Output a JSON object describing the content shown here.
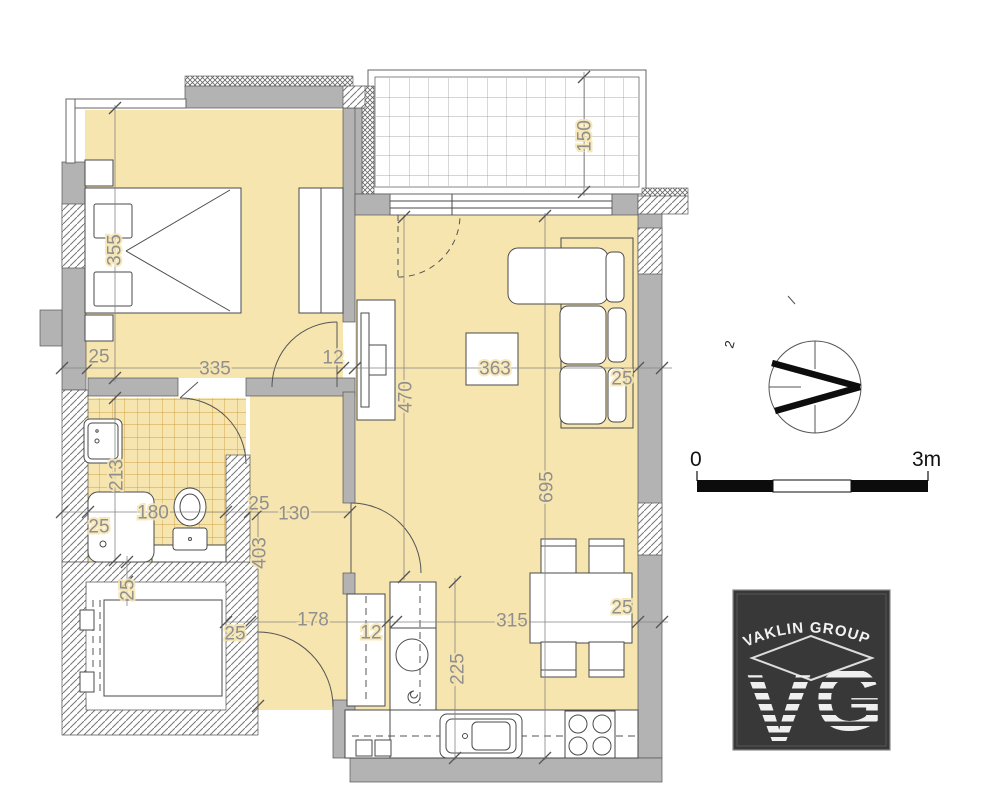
{
  "dimensions": [
    {
      "label": "355",
      "x": 115,
      "y": 250,
      "rotated": true
    },
    {
      "label": "25",
      "x": 99,
      "y": 357,
      "rotated": false
    },
    {
      "label": "335",
      "x": 215,
      "y": 369,
      "rotated": false
    },
    {
      "label": "12",
      "x": 333,
      "y": 358,
      "rotated": false
    },
    {
      "label": "150",
      "x": 585,
      "y": 136,
      "rotated": true
    },
    {
      "label": "363",
      "x": 495,
      "y": 369,
      "rotated": false
    },
    {
      "label": "25",
      "x": 622,
      "y": 379,
      "rotated": false
    },
    {
      "label": "470",
      "x": 406,
      "y": 397,
      "rotated": true
    },
    {
      "label": "695",
      "x": 547,
      "y": 487,
      "rotated": true
    },
    {
      "label": "213",
      "x": 117,
      "y": 475,
      "rotated": true
    },
    {
      "label": "180",
      "x": 153,
      "y": 513,
      "rotated": false
    },
    {
      "label": "25",
      "x": 99,
      "y": 527,
      "rotated": false
    },
    {
      "label": "25",
      "x": 259,
      "y": 504,
      "rotated": false
    },
    {
      "label": "130",
      "x": 294,
      "y": 514,
      "rotated": false
    },
    {
      "label": "403",
      "x": 260,
      "y": 553,
      "rotated": true
    },
    {
      "label": "25",
      "x": 128,
      "y": 590,
      "rotated": true
    },
    {
      "label": "25",
      "x": 235,
      "y": 634,
      "rotated": false
    },
    {
      "label": "178",
      "x": 313,
      "y": 620,
      "rotated": false
    },
    {
      "label": "12",
      "x": 371,
      "y": 633,
      "rotated": false
    },
    {
      "label": "315",
      "x": 512,
      "y": 621,
      "rotated": false
    },
    {
      "label": "25",
      "x": 622,
      "y": 608,
      "rotated": false
    },
    {
      "label": "225",
      "x": 458,
      "y": 669,
      "rotated": true
    }
  ],
  "scale_bar": {
    "start_label": "0",
    "end_label": "3m"
  },
  "compass": {
    "stray_label": "2"
  },
  "logo": {
    "company_name": "VAKLIN GROUP",
    "monogram_left": "V",
    "monogram_right": "G"
  }
}
